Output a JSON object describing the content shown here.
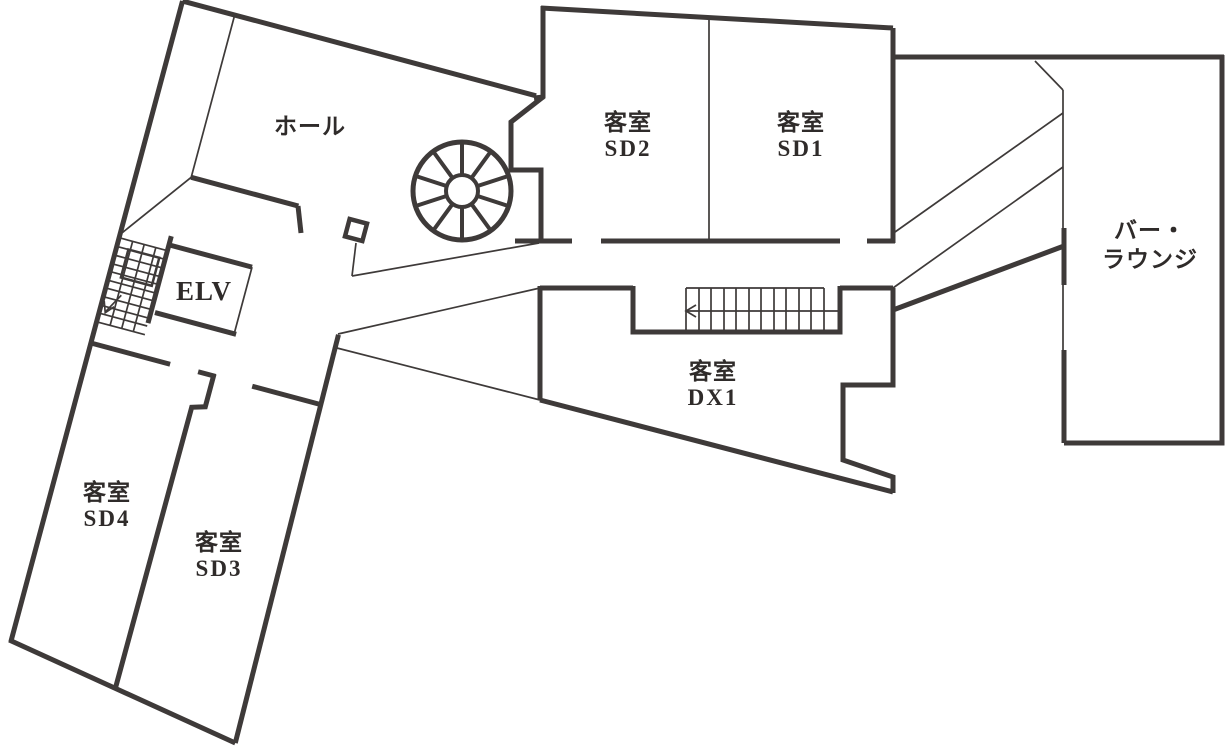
{
  "plan": {
    "rooms": {
      "hall": {
        "label": "ホール"
      },
      "guest_room_sd2": {
        "type_label": "客室",
        "number_label": "SD2"
      },
      "guest_room_sd1": {
        "type_label": "客室",
        "number_label": "SD1"
      },
      "bar_lounge": {
        "label_line1": "バー・",
        "label_line2": "ラウンジ"
      },
      "elevator": {
        "label": "ELV"
      },
      "guest_room_dx1": {
        "type_label": "客室",
        "number_label": "DX1"
      },
      "guest_room_sd4": {
        "type_label": "客室",
        "number_label": "SD4"
      },
      "guest_room_sd3": {
        "type_label": "客室",
        "number_label": "SD3"
      }
    },
    "colors": {
      "wall": "#3e3a39",
      "text": "#2f2b2a",
      "background": "#ffffff"
    }
  }
}
